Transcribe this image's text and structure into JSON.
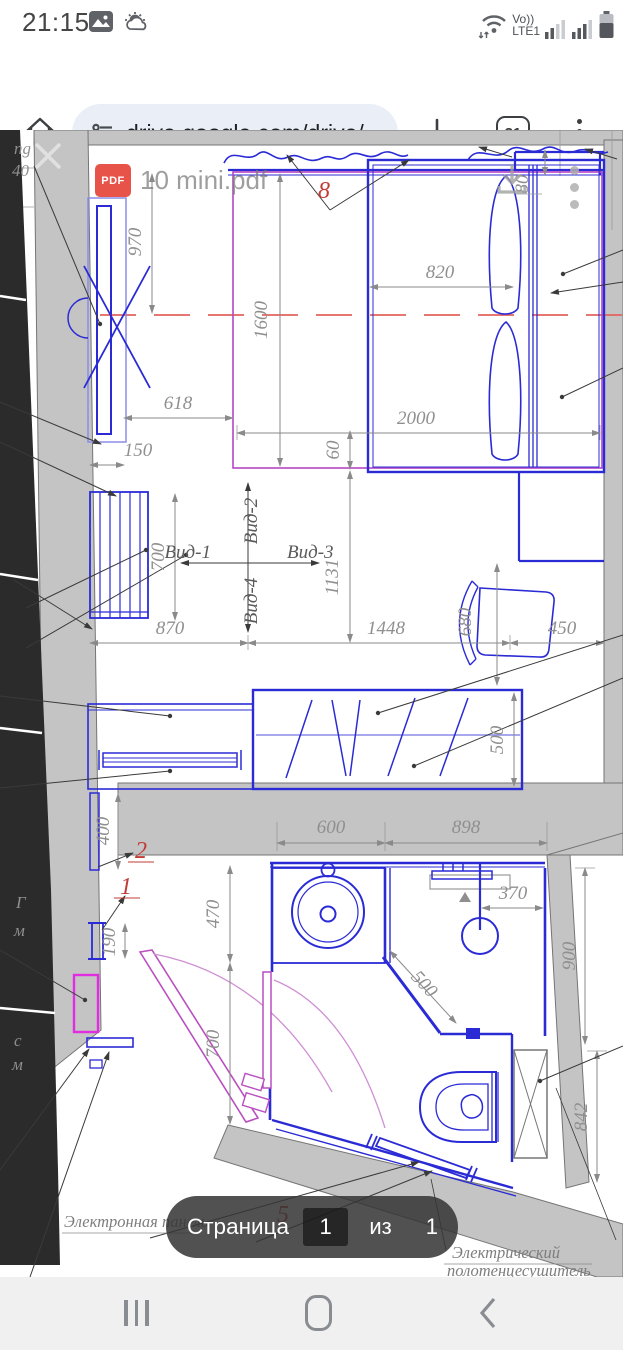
{
  "status_bar": {
    "time": "21:15",
    "volte_label": "Vo))",
    "network_label": "LTE1"
  },
  "browser_bar": {
    "url": "drive.google.com/drive/",
    "tab_count": "31"
  },
  "pdf_overlay": {
    "filename": "10 mini.pdf",
    "badge_label": "PDF"
  },
  "page_indicator": {
    "label": "Страница",
    "current_page": "1",
    "of_label": "из",
    "total_pages": "1"
  },
  "plan": {
    "dims": {
      "d970": "970",
      "d1600": "1600",
      "d820": "820",
      "d2000": "2000",
      "d618": "618",
      "d150": "150",
      "d60": "60",
      "d80": "80",
      "d700a": "700",
      "d1131": "1131",
      "d870": "870",
      "d1448": "1448",
      "d450": "450",
      "d680": "680",
      "d500a": "500",
      "d400": "400",
      "d600": "600",
      "d898": "898",
      "d470": "470",
      "d190": "190",
      "d700b": "700",
      "d370": "370",
      "d500b": "500",
      "d900": "900",
      "d842": "842"
    },
    "views": {
      "v1": "Вид-1",
      "v2": "Вид-2",
      "v3": "Вид-3",
      "v4": "Вид-4"
    },
    "callouts": {
      "c8": "8",
      "c2": "2",
      "c1": "1",
      "c5": "5"
    },
    "notes": {
      "panel": "Электронная панель",
      "towel_line1": "Электрический",
      "towel_line2": "полотенцесушитель"
    },
    "clips": {
      "t1": "ng",
      "t2": "40",
      "t3": "Г",
      "t4": "м",
      "t5": "с",
      "t6": "м"
    }
  }
}
